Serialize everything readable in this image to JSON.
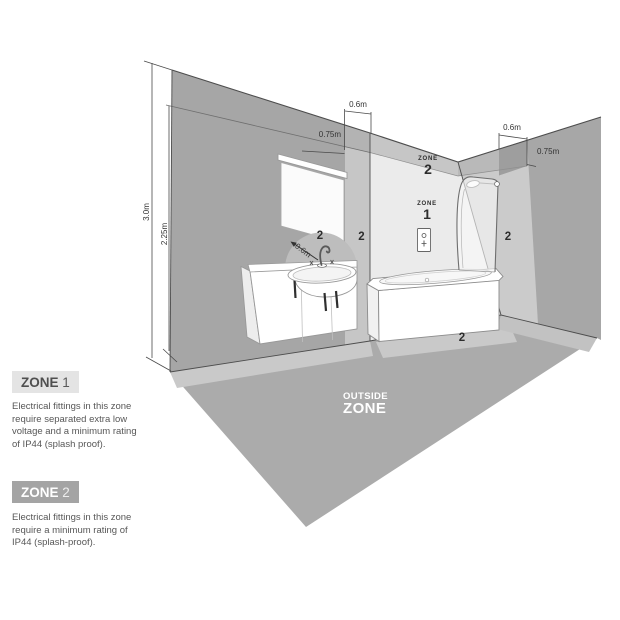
{
  "legend": {
    "zone1": {
      "badge_word": "ZONE",
      "badge_number": "1",
      "description": "Electrical fittings in this zone\nrequire separated extra low\nvoltage and a minimum rating\nof IP44 (splash proof)."
    },
    "zone2": {
      "badge_word": "ZONE",
      "badge_number": "2",
      "description": "Electrical fittings in this zone\nrequire a minimum rating of\nIP44 (splash-proof)."
    }
  },
  "diagram": {
    "dimensions": {
      "room_height": "3.0m",
      "zone_height": "2.25m",
      "left_band_width": "0.6m",
      "left_band_depth": "0.75m",
      "right_band_width": "0.6m",
      "right_band_depth": "0.75m",
      "basin_radius": "0.6m"
    },
    "labels": {
      "zone2_word": "ZONE",
      "zone2_number": "2",
      "zone1_word": "ZONE",
      "zone1_number": "1",
      "outside_line1": "OUTSIDE",
      "outside_line2": "ZONE",
      "marker_left_wall": "2",
      "marker_basin": "2",
      "marker_right_wall": "2",
      "marker_floor": "2"
    },
    "colors": {
      "left_wall": "#a6a6a6",
      "left_wall_zone_band": "#c6c6c6",
      "back_wall": "#ebebeb",
      "back_wall_top_band": "#c6c6c6",
      "right_wall": "#a7a7a7",
      "right_wall_zone": "#cbcbcb",
      "right_wall_patch": "#9e9e9e",
      "floor": "#ababab",
      "floor_zone_band": "#c9c9c9",
      "basin_zone_circle": "#bdbdbd",
      "outline": "#4d4d4d"
    }
  }
}
